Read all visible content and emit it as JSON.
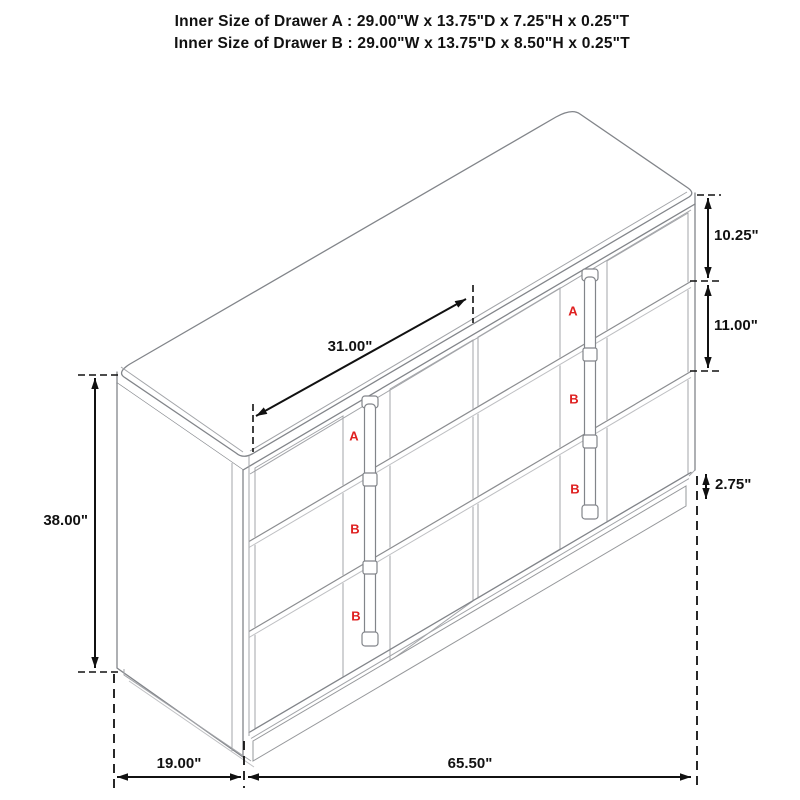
{
  "title": {
    "line1": "Inner Size of Drawer A : 29.00\"W x 13.75\"D x 7.25\"H x 0.25\"T",
    "line2": "Inner Size of Drawer B : 29.00\"W x 13.75\"D x 8.50\"H x 0.25\"T"
  },
  "dimensions": {
    "drawer_front_width": "31.00\"",
    "top_drawer_height": "10.25\"",
    "middle_drawer_height": "11.00\"",
    "base_height": "2.75\"",
    "overall_height": "38.00\"",
    "overall_depth": "19.00\"",
    "overall_width": "65.50\""
  },
  "drawer_labels": {
    "left_column": [
      "A",
      "B",
      "B"
    ],
    "right_column": [
      "A",
      "B",
      "B"
    ]
  },
  "colors": {
    "drawer_label_red": "#df2020",
    "drawing_line_gray": "#9b9da1",
    "dimension_line_black": "#111111",
    "background": "#ffffff"
  }
}
